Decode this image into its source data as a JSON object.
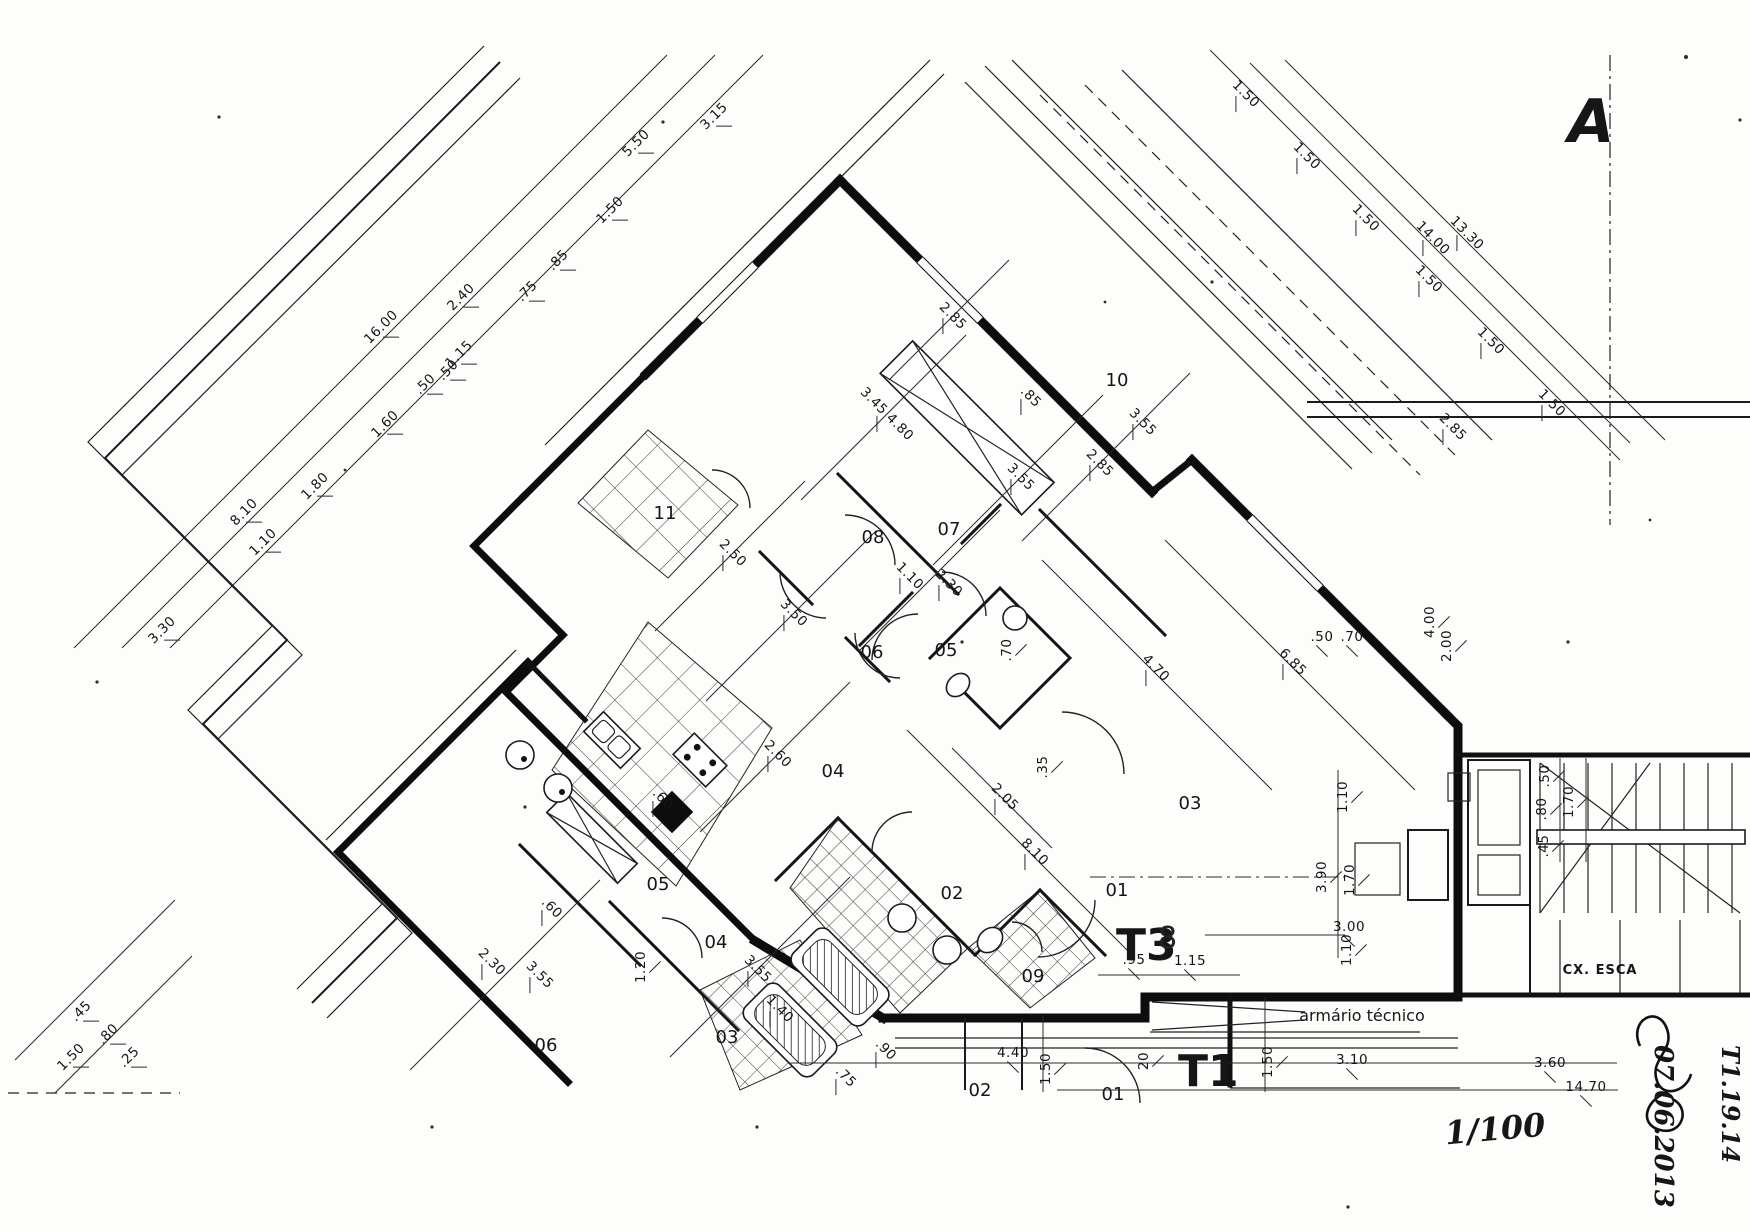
{
  "title": "Apartment floor plan (scan)",
  "marker": {
    "section": "A"
  },
  "units": {
    "t3": "T3",
    "t3_overprint": "8",
    "t1": "T1"
  },
  "annotations": {
    "armario": "armário técnico",
    "stairwell": "CX. ESCA",
    "scale": "1/100",
    "date": "07.06.2013",
    "ref": "T1.19.14"
  },
  "room_labels": [
    {
      "t": "01",
      "x": 1117,
      "y": 896
    },
    {
      "t": "02",
      "x": 952,
      "y": 899
    },
    {
      "t": "03",
      "x": 1190,
      "y": 809
    },
    {
      "t": "04",
      "x": 833,
      "y": 777
    },
    {
      "t": "05",
      "x": 946,
      "y": 656
    },
    {
      "t": "06",
      "x": 872,
      "y": 658
    },
    {
      "t": "07",
      "x": 949,
      "y": 535
    },
    {
      "t": "08",
      "x": 873,
      "y": 543
    },
    {
      "t": "09",
      "x": 1033,
      "y": 982
    },
    {
      "t": "10",
      "x": 1117,
      "y": 386
    },
    {
      "t": "11",
      "x": 665,
      "y": 519
    },
    {
      "t": "01",
      "x": 1113,
      "y": 1100
    },
    {
      "t": "02",
      "x": 980,
      "y": 1096
    },
    {
      "t": "03",
      "x": 727,
      "y": 1043
    },
    {
      "t": "04",
      "x": 716,
      "y": 948
    },
    {
      "t": "05",
      "x": 658,
      "y": 890
    },
    {
      "t": "06",
      "x": 546,
      "y": 1051
    }
  ],
  "dimensions": {
    "upper_left": [
      {
        "t": "3.30",
        "x": 165,
        "y": 633,
        "r": -45
      },
      {
        "t": "1.10",
        "x": 266,
        "y": 545,
        "r": -45
      },
      {
        "t": "8.10",
        "x": 247,
        "y": 515,
        "r": -45
      },
      {
        "t": "1.80",
        "x": 318,
        "y": 489,
        "r": -45
      },
      {
        "t": "1.60",
        "x": 388,
        "y": 427,
        "r": -45
      },
      {
        "t": "16.00",
        "x": 384,
        "y": 330,
        "r": -45
      },
      {
        "t": ".50",
        "x": 428,
        "y": 387,
        "r": -45
      },
      {
        "t": ".50",
        "x": 451,
        "y": 373,
        "r": -45
      },
      {
        "t": "1.15",
        "x": 462,
        "y": 357,
        "r": -45
      },
      {
        "t": "2.40",
        "x": 464,
        "y": 300,
        "r": -45
      },
      {
        "t": ".75",
        "x": 530,
        "y": 294,
        "r": -45
      },
      {
        "t": ".85",
        "x": 561,
        "y": 263,
        "r": -45
      },
      {
        "t": "1.50",
        "x": 613,
        "y": 213,
        "r": -45
      },
      {
        "t": "5.50",
        "x": 639,
        "y": 146,
        "r": -45
      },
      {
        "t": "3.15",
        "x": 717,
        "y": 119,
        "r": -45
      }
    ],
    "top_right": [
      {
        "t": "1.50",
        "x": 1243,
        "y": 97,
        "r": 45
      },
      {
        "t": "1.50",
        "x": 1304,
        "y": 159,
        "r": 45
      },
      {
        "t": "1.50",
        "x": 1363,
        "y": 221,
        "r": 45
      },
      {
        "t": "1.50",
        "x": 1426,
        "y": 282,
        "r": 45
      },
      {
        "t": "1.50",
        "x": 1488,
        "y": 344,
        "r": 45
      },
      {
        "t": "1.50",
        "x": 1549,
        "y": 406,
        "r": 45
      },
      {
        "t": "14.00",
        "x": 1430,
        "y": 241,
        "r": 45
      },
      {
        "t": "13.30",
        "x": 1464,
        "y": 236,
        "r": 45
      },
      {
        "t": "2.85",
        "x": 1450,
        "y": 430,
        "r": 45
      }
    ],
    "right_side": [
      {
        "t": ".50",
        "x": 1322,
        "y": 641,
        "r": 0
      },
      {
        "t": ".70",
        "x": 1352,
        "y": 641,
        "r": 0
      },
      {
        "t": "4.00",
        "x": 1434,
        "y": 622,
        "r": -90
      },
      {
        "t": "2.00",
        "x": 1451,
        "y": 646,
        "r": -90
      },
      {
        "t": ".50",
        "x": 1549,
        "y": 776,
        "r": -90
      },
      {
        "t": ".80",
        "x": 1546,
        "y": 809,
        "r": -90
      },
      {
        "t": "1.70",
        "x": 1573,
        "y": 802,
        "r": -90
      },
      {
        "t": ".45",
        "x": 1548,
        "y": 846,
        "r": -90
      },
      {
        "t": "1.10",
        "x": 1347,
        "y": 797,
        "r": -90
      },
      {
        "t": "3.90",
        "x": 1326,
        "y": 877,
        "r": -90
      },
      {
        "t": "1.70",
        "x": 1354,
        "y": 880,
        "r": -90
      },
      {
        "t": "3.00",
        "x": 1349,
        "y": 931,
        "r": 0
      },
      {
        "t": "1.10",
        "x": 1351,
        "y": 950,
        "r": -90
      }
    ],
    "bottom": [
      {
        "t": ".95",
        "x": 1134,
        "y": 964,
        "r": 0
      },
      {
        "t": "1.15",
        "x": 1190,
        "y": 965,
        "r": 0
      },
      {
        "t": "4.40",
        "x": 1013,
        "y": 1057,
        "r": 0
      },
      {
        "t": "1.50",
        "x": 1050,
        "y": 1069,
        "r": -90
      },
      {
        "t": "20",
        "x": 1148,
        "y": 1061,
        "r": -90
      },
      {
        "t": "1.50",
        "x": 1272,
        "y": 1062,
        "r": -90
      },
      {
        "t": "3.10",
        "x": 1352,
        "y": 1064,
        "r": 0
      },
      {
        "t": "3.60",
        "x": 1550,
        "y": 1067,
        "r": 0
      },
      {
        "t": "14.70",
        "x": 1586,
        "y": 1091,
        "r": 0
      }
    ],
    "bottom_left": [
      {
        "t": "1.50",
        "x": 74,
        "y": 1060,
        "r": -45
      },
      {
        "t": ".45",
        "x": 84,
        "y": 1014,
        "r": -45
      },
      {
        "t": ".80",
        "x": 111,
        "y": 1037,
        "r": -45
      },
      {
        "t": ".25",
        "x": 132,
        "y": 1060,
        "r": -45
      }
    ],
    "interior": [
      {
        "t": "2.85",
        "x": 950,
        "y": 319,
        "r": 45
      },
      {
        "t": "3.45 4.80",
        "x": 884,
        "y": 417,
        "r": 45
      },
      {
        "t": "3.55",
        "x": 1018,
        "y": 480,
        "r": 45
      },
      {
        "t": ".85",
        "x": 1028,
        "y": 400,
        "r": 45
      },
      {
        "t": "2.85",
        "x": 1097,
        "y": 466,
        "r": 45
      },
      {
        "t": "3.55",
        "x": 1140,
        "y": 425,
        "r": 45
      },
      {
        "t": "2.50",
        "x": 730,
        "y": 556,
        "r": 45
      },
      {
        "t": "3.50",
        "x": 791,
        "y": 616,
        "r": 45
      },
      {
        "t": "1.10",
        "x": 907,
        "y": 579,
        "r": 45
      },
      {
        "t": "2.30",
        "x": 946,
        "y": 586,
        "r": 45
      },
      {
        "t": ".70",
        "x": 1011,
        "y": 650,
        "r": -90
      },
      {
        "t": "2.60",
        "x": 775,
        "y": 757,
        "r": 45
      },
      {
        "t": ".60",
        "x": 660,
        "y": 802,
        "r": 45
      },
      {
        "t": ".60",
        "x": 549,
        "y": 911,
        "r": 45
      },
      {
        "t": "2.30",
        "x": 489,
        "y": 965,
        "r": 45
      },
      {
        "t": "3.55",
        "x": 537,
        "y": 978,
        "r": 45
      },
      {
        "t": "1.20",
        "x": 645,
        "y": 967,
        "r": -90
      },
      {
        "t": "3.55",
        "x": 755,
        "y": 972,
        "r": 45
      },
      {
        "t": "1.40",
        "x": 777,
        "y": 1012,
        "r": 45
      },
      {
        "t": ".90",
        "x": 883,
        "y": 1053,
        "r": 45
      },
      {
        "t": ".75",
        "x": 843,
        "y": 1080,
        "r": 45
      },
      {
        "t": "2.05",
        "x": 1002,
        "y": 800,
        "r": 45
      },
      {
        "t": "8.10",
        "x": 1032,
        "y": 855,
        "r": 45
      },
      {
        "t": "4.70",
        "x": 1153,
        "y": 671,
        "r": 45
      },
      {
        "t": "6.85",
        "x": 1290,
        "y": 665,
        "r": 45
      },
      {
        "t": ".35",
        "x": 1047,
        "y": 767,
        "r": -90
      }
    ]
  }
}
